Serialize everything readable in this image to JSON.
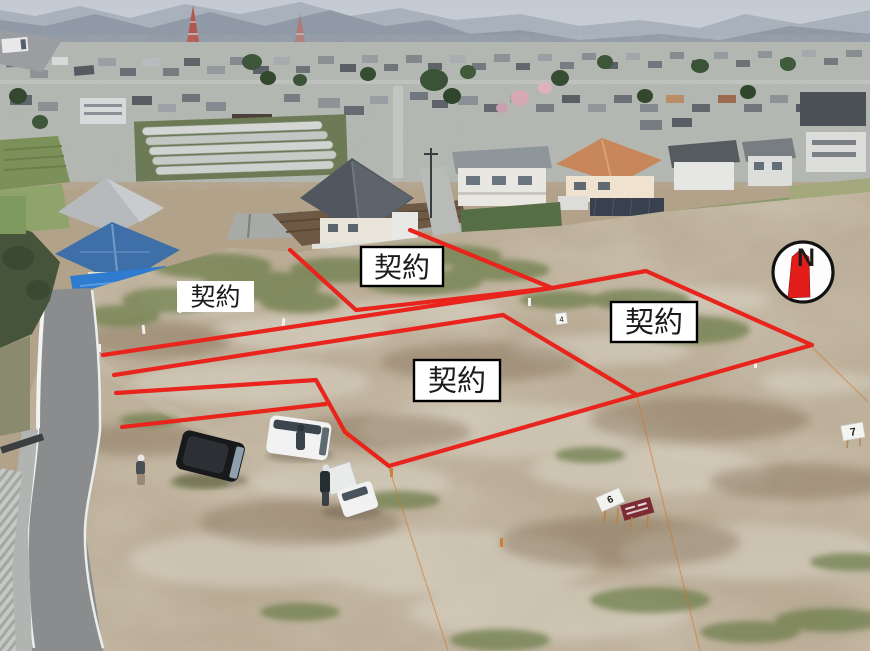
{
  "annotations": {
    "contract_labels": [
      {
        "id": "plot-upper-left",
        "text": "契約"
      },
      {
        "id": "plot-upper-middle",
        "text": "契約"
      },
      {
        "id": "plot-right",
        "text": "契約"
      },
      {
        "id": "plot-center",
        "text": "契約"
      }
    ],
    "compass": {
      "north_letter": "N"
    },
    "site_markers": [
      {
        "id": "marker-4",
        "text": "4"
      },
      {
        "id": "marker-6",
        "text": "6"
      },
      {
        "id": "marker-7",
        "text": "7"
      }
    ],
    "colors": {
      "boundary_red": "#e8241c",
      "label_background": "#ffffff",
      "label_text": "#1b1b1b",
      "compass_arrow": "#e31e1a"
    }
  }
}
